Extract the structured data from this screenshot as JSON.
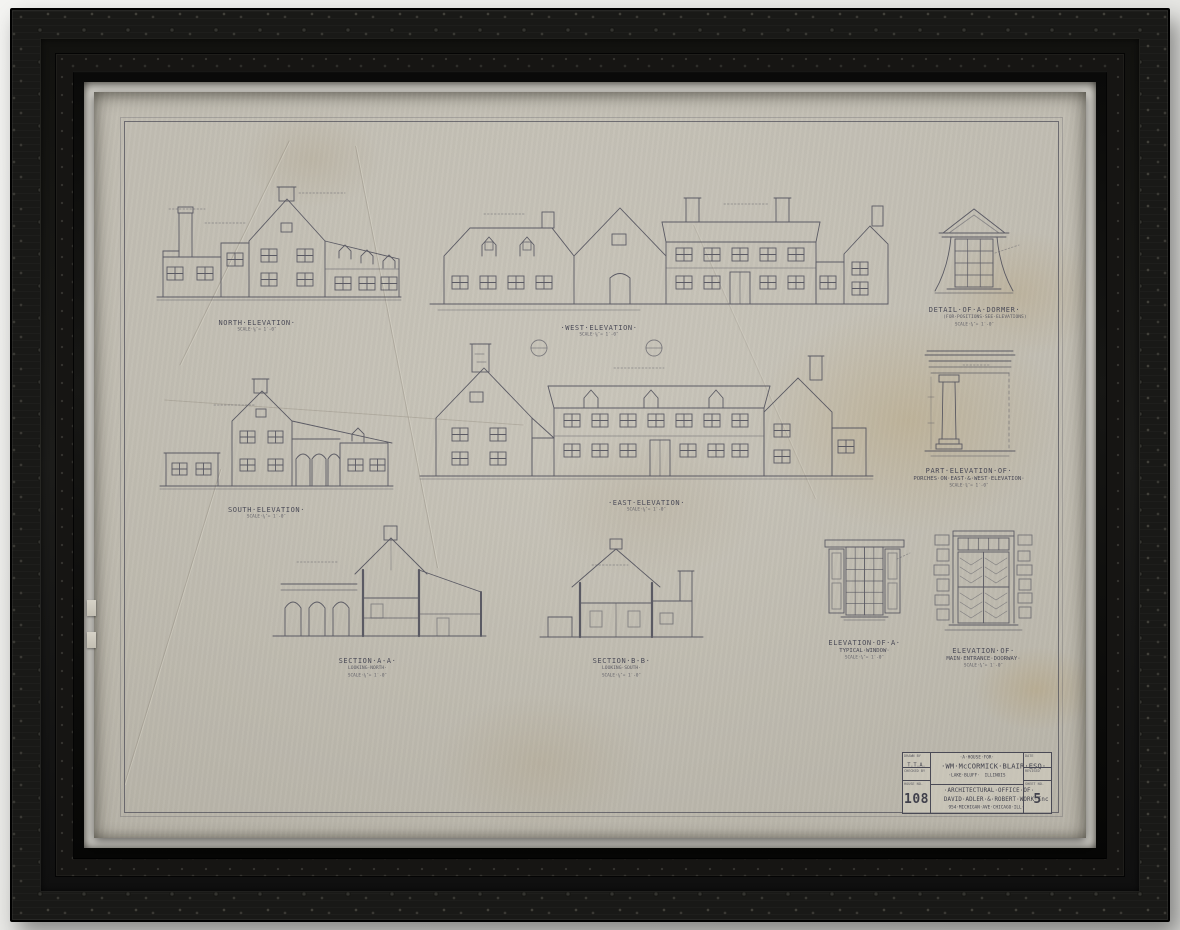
{
  "colors": {
    "paper": "#c8c4b9",
    "ink": "#4e4e5a",
    "frame": "#161614",
    "mat": "#e7e5df"
  },
  "sheet": {
    "figures": {
      "north": {
        "title": "NORTH·ELEVATION·",
        "scale": "SCALE·⅛″= 1′-0″"
      },
      "west": {
        "title": "·WEST·ELEVATION·",
        "scale": "SCALE·⅛″= 1′-0″"
      },
      "south": {
        "title": "SOUTH·ELEVATION·",
        "scale": "SCALE·⅛″= 1′-0″"
      },
      "east": {
        "title": "·EAST·ELEVATION·",
        "scale": "SCALE·⅛″= 1′-0″"
      },
      "section_a": {
        "title": "SECTION·A-A·",
        "note": "LOOKING·NORTH·",
        "scale": "SCALE·⅛″= 1′-0″"
      },
      "section_b": {
        "title": "SECTION·B-B·",
        "note": "LOOKING·SOUTH·",
        "scale": "SCALE·⅛″= 1′-0″"
      },
      "dormer": {
        "title": "DETAIL·OF·A·DORMER·",
        "note": "(FOR·POSITIONS·SEE·ELEVATIONS)",
        "scale": "SCALE·¾″= 1′-0″"
      },
      "porch": {
        "title": "PART·ELEVATION·OF·",
        "title2": "PORCHES·ON·EAST·&·WEST·ELEVATION·",
        "scale": "SCALE·¾″= 1′-0″"
      },
      "window": {
        "title": "ELEVATION·OF·A·",
        "title2": "TYPICAL·WINDOW·",
        "scale": "SCALE·¾″= 1′-0″"
      },
      "doorway": {
        "title": "ELEVATION·OF·",
        "title2": "MAIN·ENTRANCE·DOORWAY·",
        "scale": "SCALE·¾″= 1′-0″"
      }
    },
    "title_block": {
      "drawn_by_label": "DRAWN BY",
      "drawn_by": "T.T.A.",
      "checked_label": "CHECKED BY",
      "house_label": "HOUSE NO.",
      "house_no": "108",
      "project_prefix": "·A·HOUSE·FOR·",
      "client": "·WM·McCORMICK·BLAIR·ESQ·",
      "town": "·LAKE·BLUFF·",
      "state": "ILLINOIS",
      "firm1": "·ARCHITECTURAL·OFFICE·OF·",
      "firm2": "DAVID·ADLER·&·ROBERT·WORK·Inc",
      "addr1": "954·MICHIGAN·AVE·",
      "addr2": "CHICAGO·ILL·",
      "date_label": "DATE",
      "revised_label": "REVISED",
      "sheet_label": "SHEET NO.",
      "sheet_no": "5"
    }
  }
}
